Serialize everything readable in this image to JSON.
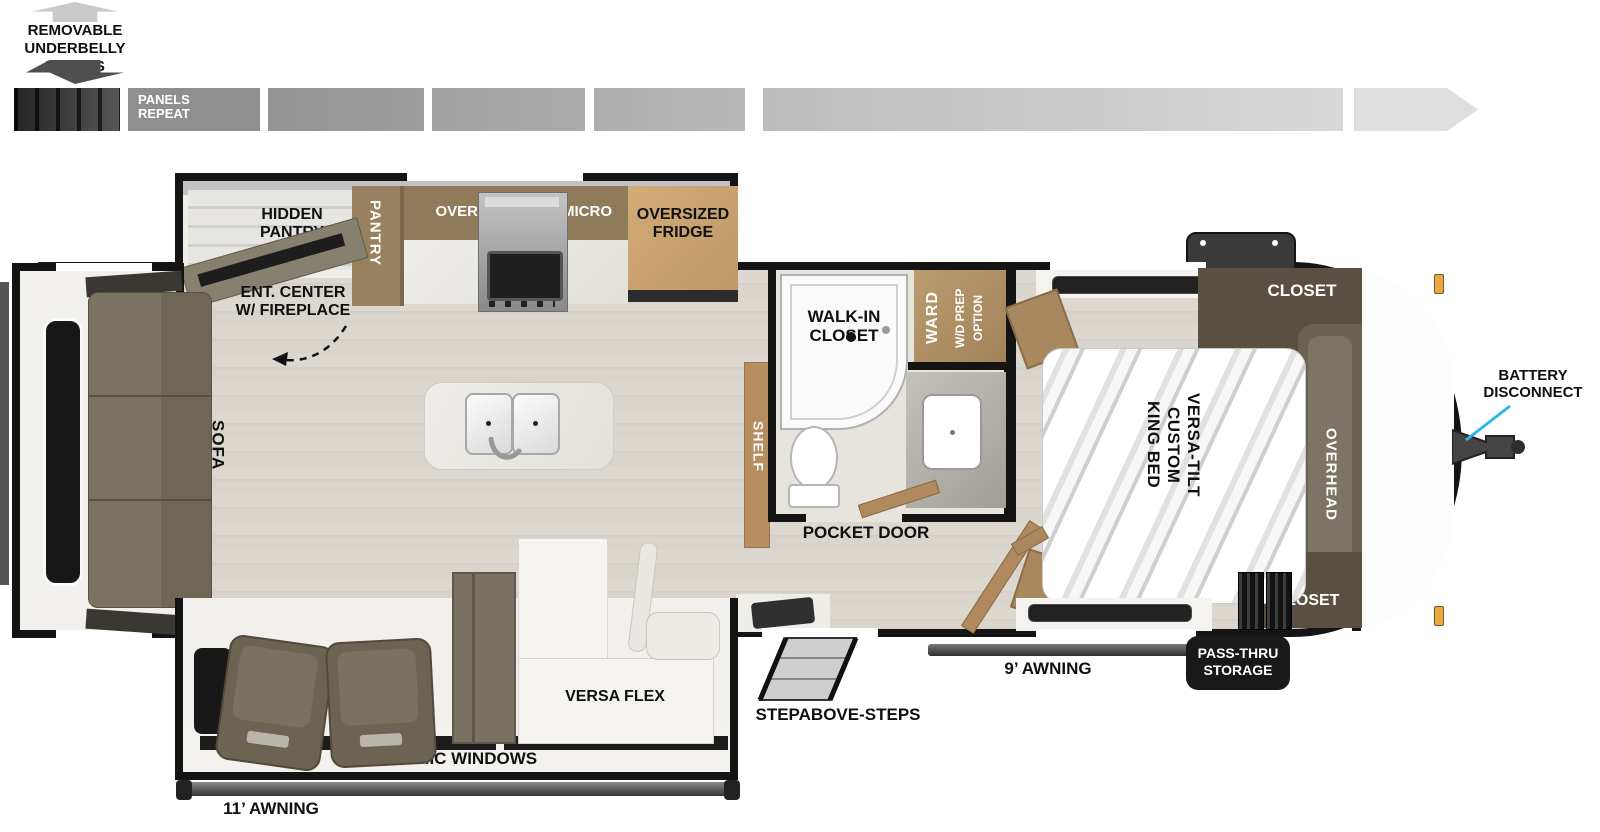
{
  "colors": {
    "wall": "#141414",
    "accent_line": "#2cb7ea",
    "cabinet_brown": "#8f7a5a",
    "closet_brown": "#5a5041",
    "fridge_tan": "#c8a671",
    "shelf_tan": "#b68e60",
    "sofa_gray_brown": "#7b7261",
    "floor": "#d9d5cc",
    "marker_light": "#e9a93e",
    "panel_gray_dark": "#4a4a4a",
    "panel_gray_light": "#dedede"
  },
  "underbelly": {
    "lines": [
      "REMOVABLE",
      "UNDERBELLY",
      "PANELS"
    ],
    "panels_repeat_lines": [
      "PANELS",
      "REPEAT"
    ]
  },
  "kitchen": {
    "hidden_pantry": [
      "HIDDEN",
      "PANTRY"
    ],
    "pantry": "PANTRY",
    "overhead": "OVERHEAD",
    "micro": "MICRO",
    "fridge": [
      "OVERSIZED",
      "FRIDGE"
    ],
    "ent_center": [
      "ENT. CENTER",
      "W/ FIREPLACE"
    ]
  },
  "living": {
    "sofa": "SOFA",
    "shelf": "SHELF",
    "versa_flex": "VERSA FLEX",
    "panoramic": "PANORAMIC WINDOWS",
    "awning_11": "11’ AWNING"
  },
  "bath": {
    "walk_in": [
      "WALK-IN",
      "CLOSET"
    ],
    "ward": "WARD",
    "wd_prep": "W/D PREP",
    "option": "OPTION",
    "pocket_door": "POCKET DOOR"
  },
  "bedroom": {
    "closet_top": "CLOSET",
    "closet_bottom": "CLOSET",
    "overhead": "OVERHEAD",
    "bed": [
      "VERSA-TILT",
      "CUSTOM",
      "KING BED"
    ]
  },
  "exterior": {
    "battery": [
      "BATTERY",
      "DISCONNECT"
    ],
    "pass_thru": [
      "PASS-THRU",
      "STORAGE"
    ],
    "awning_9": "9’ AWNING",
    "steps": "STEPABOVE-STEPS"
  }
}
